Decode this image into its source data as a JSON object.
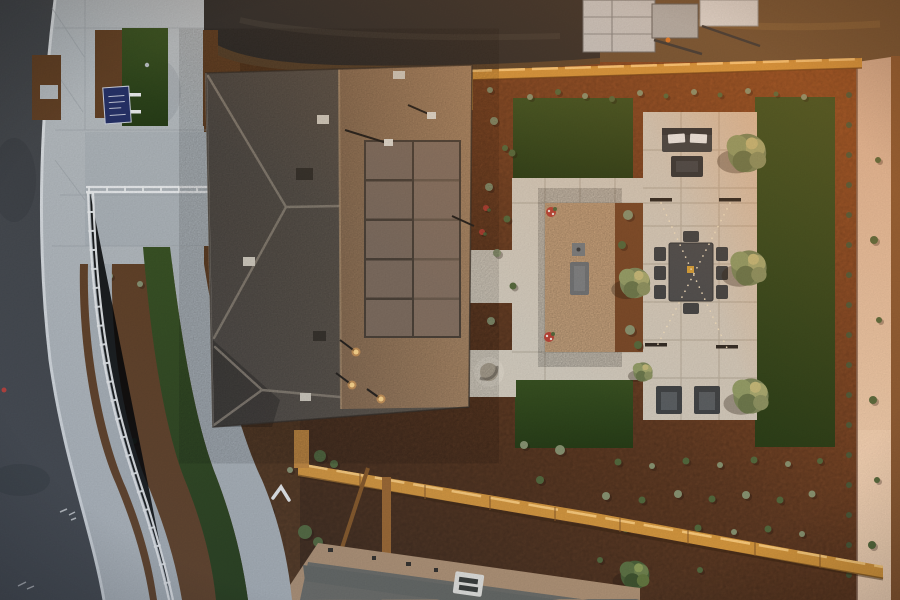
{
  "meta": {
    "image_type": "aerial-drone-photo",
    "time_of_day": "dusk, low warm sun from upper right",
    "subject": "top-down view of a model home: curved street and sidewalk at left, hip roof with solar panel array, xeriscaped backyard with paver courtyard, gravel seating area, artificial turf rectangles, string lights, wood fences, sunlit block wall at right",
    "visible_text": []
  },
  "palette": {
    "colors": {
      "asphalt": "#46494d",
      "asphaltDark": "#393c40",
      "concrete": "#b7bdc1",
      "walk": "#afb6bb",
      "curb": "#dde1e4",
      "jointLine": "#9aa1a6",
      "mulchFront": "#644226",
      "mulchDark": "#4e3520",
      "mulchWarm": "#a85a2a",
      "turf": "#2f481d",
      "turfDark": "#283e18",
      "roofDark": "#5f584e",
      "roofLit": "#a8896a",
      "ridge": "#9b9183",
      "solar": "#7e6d60",
      "solarFrame": "#4c4239",
      "paver": "#d5cec1",
      "paverLine": "#b3aa9b",
      "gravel": "#dcb68e",
      "wood": "#d8993f",
      "woodGlint": "#ffce7d",
      "woodDark": "#8a5a28",
      "wall": "#e5c3a8",
      "dirtDark": "#2f2e2d",
      "dirtBrown": "#6b5237",
      "dirtWarm": "#c08048",
      "white": "#eef0f1",
      "furn": "#3f4448",
      "furnLight": "#5a6065",
      "signBlue": "#27336a",
      "glow": "#ffb55e"
    },
    "plant_colors": {
      "s": "#8a9573",
      "g": "#556b3f",
      "d": "#49593a",
      "y": "#b4b261",
      "f": "#c9a93e",
      "r": "#bb4438"
    }
  },
  "scene": {
    "regions": [
      "street",
      "curb",
      "sidewalk",
      "front-plaza",
      "front-turf-band",
      "white-railing-path",
      "front-yard-sign",
      "main-roof",
      "solar-array",
      "graded-dirt-lot",
      "construction-structure",
      "backyard-mulch",
      "paver-courtyard",
      "gravel-court",
      "turf-rect-top",
      "turf-rect-right",
      "turf-rect-bottom",
      "top-fence",
      "bottom-fence",
      "block-wall",
      "neighbor-roof"
    ],
    "furniture": [
      "outdoor-sofa-2-pillows",
      "fire-pit-table",
      "dining-table-8-chairs",
      "two-armchairs",
      "bench",
      "side-table",
      "fire-bowl",
      "string-light-posts"
    ],
    "solar_array": {
      "columns": 2,
      "rows": 5
    },
    "string_lights": {
      "pattern": "X",
      "posts": 4
    },
    "flower_pots": [
      [
        551,
        212
      ],
      [
        549,
        337
      ]
    ],
    "trees": [
      {
        "x": 80,
        "y": 518,
        "s": 1.1,
        "v": "g"
      },
      {
        "x": 25,
        "y": 328,
        "s": 1.0,
        "v": "y"
      },
      {
        "x": 747,
        "y": 153,
        "s": 1.2,
        "v": "s"
      },
      {
        "x": 749,
        "y": 268,
        "s": 1.1,
        "v": "s"
      },
      {
        "x": 751,
        "y": 396,
        "s": 1.1,
        "v": "s"
      },
      {
        "x": 635,
        "y": 283,
        "s": 0.95,
        "v": "s"
      },
      {
        "x": 635,
        "y": 575,
        "s": 0.9,
        "v": "g"
      },
      {
        "x": 643,
        "y": 372,
        "s": 0.6,
        "v": "s"
      },
      {
        "x": 445,
        "y": 300,
        "s": 0.7,
        "v": "s"
      }
    ],
    "plant_rows": [
      {
        "x": 849,
        "y0": 95,
        "y1": 575,
        "step": 30,
        "r": 3,
        "c": "d"
      }
    ],
    "plants": [
      [
        530,
        97,
        3,
        "s"
      ],
      [
        558,
        92,
        3,
        "g"
      ],
      [
        585,
        96,
        3,
        "s"
      ],
      [
        612,
        99,
        3,
        "g"
      ],
      [
        640,
        93,
        3,
        "s"
      ],
      [
        666,
        96,
        2.5,
        "g"
      ],
      [
        694,
        92,
        3,
        "s"
      ],
      [
        720,
        95,
        2.5,
        "g"
      ],
      [
        748,
        91,
        3,
        "s"
      ],
      [
        776,
        94,
        2.5,
        "g"
      ],
      [
        804,
        97,
        3,
        "s"
      ],
      [
        494,
        121,
        4,
        "s"
      ],
      [
        512,
        153,
        3.5,
        "g"
      ],
      [
        489,
        187,
        4,
        "s"
      ],
      [
        507,
        219,
        3.5,
        "g"
      ],
      [
        497,
        253,
        4,
        "s"
      ],
      [
        513,
        286,
        3.5,
        "g"
      ],
      [
        491,
        321,
        4,
        "s"
      ],
      [
        486,
        208,
        3,
        "r"
      ],
      [
        482,
        232,
        3,
        "r"
      ],
      [
        628,
        215,
        5,
        "s"
      ],
      [
        622,
        245,
        4,
        "g"
      ],
      [
        630,
        330,
        5,
        "s"
      ],
      [
        638,
        345,
        4,
        "g"
      ],
      [
        618,
        462,
        3.5,
        "g"
      ],
      [
        652,
        466,
        3,
        "s"
      ],
      [
        686,
        461,
        3.5,
        "g"
      ],
      [
        720,
        465,
        3,
        "s"
      ],
      [
        754,
        460,
        3.5,
        "g"
      ],
      [
        788,
        464,
        3,
        "s"
      ],
      [
        820,
        461,
        3,
        "g"
      ],
      [
        606,
        496,
        4,
        "s"
      ],
      [
        642,
        500,
        3.5,
        "g"
      ],
      [
        678,
        494,
        4,
        "s"
      ],
      [
        712,
        499,
        3.5,
        "g"
      ],
      [
        746,
        495,
        4,
        "s"
      ],
      [
        780,
        500,
        3.5,
        "g"
      ],
      [
        812,
        494,
        3.5,
        "s"
      ],
      [
        626,
        529,
        3.5,
        "g"
      ],
      [
        662,
        533,
        3,
        "s"
      ],
      [
        698,
        528,
        3.5,
        "g"
      ],
      [
        734,
        532,
        3,
        "s"
      ],
      [
        768,
        529,
        3.5,
        "g"
      ],
      [
        802,
        534,
        3,
        "s"
      ],
      [
        600,
        560,
        3,
        "g"
      ],
      [
        640,
        566,
        3,
        "s"
      ],
      [
        700,
        570,
        3,
        "g"
      ],
      [
        560,
        450,
        5,
        "s"
      ],
      [
        540,
        480,
        4,
        "g"
      ],
      [
        524,
        445,
        4,
        "s"
      ],
      [
        320,
        456,
        6,
        "g"
      ],
      [
        334,
        464,
        4,
        "g"
      ],
      [
        305,
        532,
        7,
        "g"
      ],
      [
        318,
        542,
        5,
        "g"
      ],
      [
        398,
        590,
        5,
        "f"
      ],
      [
        352,
        592,
        4,
        "f"
      ],
      [
        408,
        560,
        3,
        "g"
      ],
      [
        440,
        575,
        3,
        "s"
      ],
      [
        268,
        510,
        5,
        "g"
      ],
      [
        255,
        576,
        4,
        "s"
      ],
      [
        290,
        470,
        3,
        "s"
      ],
      [
        44,
        96,
        3,
        "g"
      ],
      [
        52,
        110,
        3,
        "g"
      ],
      [
        103,
        46,
        2.5,
        "g"
      ],
      [
        112,
        102,
        2.5,
        "g"
      ],
      [
        209,
        50,
        2.5,
        "g"
      ],
      [
        211,
        90,
        2.5,
        "g"
      ],
      [
        110,
        276,
        3,
        "s"
      ],
      [
        140,
        284,
        3,
        "s"
      ],
      [
        168,
        273,
        3,
        "s"
      ],
      [
        100,
        332,
        3,
        "g"
      ],
      [
        110,
        369,
        3,
        "g"
      ],
      [
        122,
        406,
        3,
        "g"
      ],
      [
        134,
        441,
        3,
        "g"
      ],
      [
        92,
        532,
        4,
        "g"
      ],
      [
        878,
        160,
        3,
        "g"
      ],
      [
        874,
        240,
        4,
        "g"
      ],
      [
        879,
        320,
        3,
        "g"
      ],
      [
        873,
        400,
        4,
        "g"
      ],
      [
        877,
        480,
        3,
        "g"
      ],
      [
        872,
        545,
        4,
        "g"
      ],
      [
        490,
        90,
        3,
        "s"
      ],
      [
        505,
        148,
        3,
        "g"
      ]
    ]
  }
}
